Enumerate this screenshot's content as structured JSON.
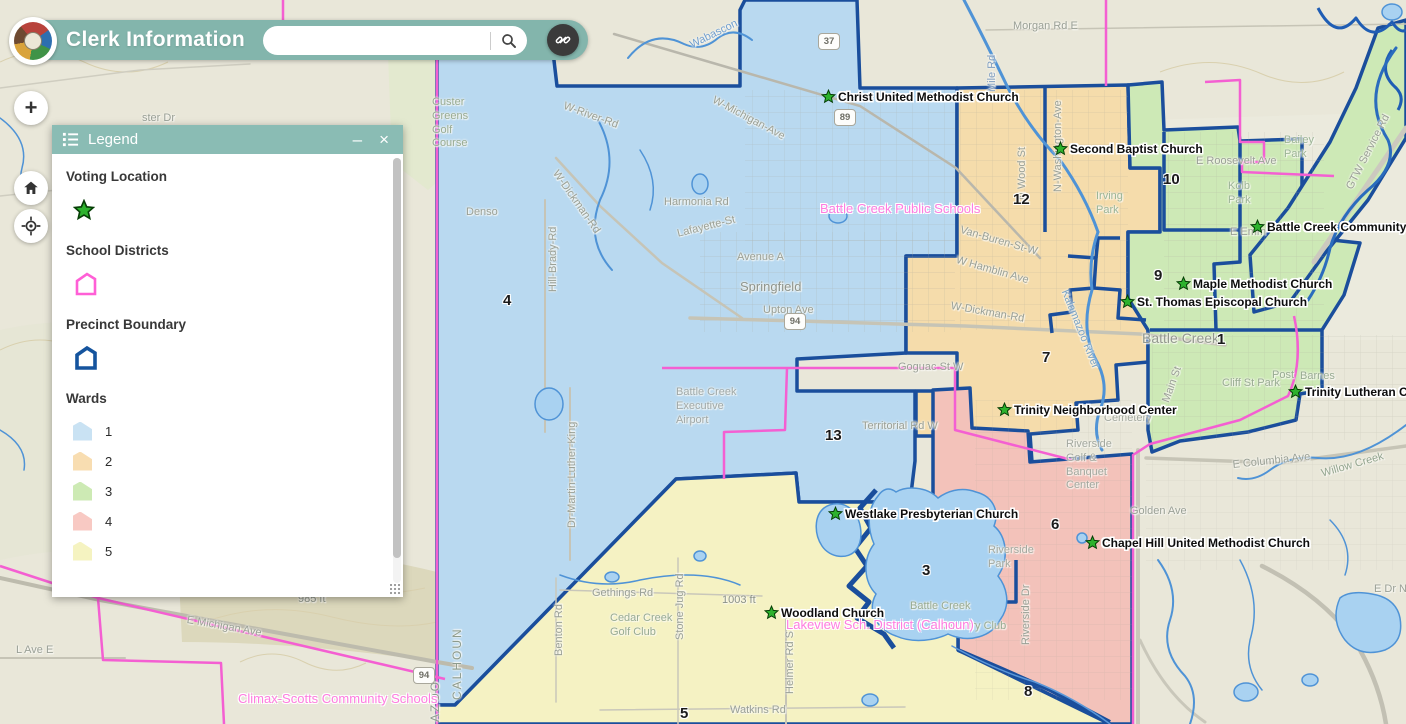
{
  "header": {
    "title": "Clerk Information",
    "search": {
      "value": "",
      "placeholder": ""
    }
  },
  "map_controls": {
    "zoom_in_label": "+"
  },
  "legend": {
    "title": "Legend",
    "minimize_label": "–",
    "close_label": "×",
    "sections": {
      "voting_location": {
        "heading": "Voting Location"
      },
      "school_districts": {
        "heading": "School Districts"
      },
      "precinct_boundary": {
        "heading": "Precinct Boundary"
      },
      "wards": {
        "heading": "Wards",
        "items": [
          {
            "label": "1",
            "fill": "#c9e2f3"
          },
          {
            "label": "2",
            "fill": "#f8ddb1"
          },
          {
            "label": "3",
            "fill": "#cdeab4"
          },
          {
            "label": "4",
            "fill": "#f8c9c3"
          },
          {
            "label": "5",
            "fill": "#f5f3c1"
          }
        ]
      }
    }
  },
  "map": {
    "colors": {
      "ward1_fill": "#b9d9f0",
      "ward2_fill": "#f5dcab",
      "ward3_fill": "#cde9b6",
      "ward4_fill": "#f3c2ba",
      "ward5_fill": "#f5f2c3",
      "precinct_line": "#1a4e9c",
      "school_district_line": "#f45fd2",
      "water_fill": "#a9d2f1",
      "voting_star": "#2db22d"
    },
    "voting_locations": [
      {
        "text": "Christ United Methodist Church",
        "x": 821,
        "y": 89
      },
      {
        "text": "Second Baptist Church",
        "x": 1053,
        "y": 141
      },
      {
        "text": "Battle Creek Community",
        "x": 1250,
        "y": 219
      },
      {
        "text": "Maple Methodist Church",
        "x": 1176,
        "y": 276
      },
      {
        "text": "St. Thomas Episcopal Church",
        "x": 1120,
        "y": 294
      },
      {
        "text": "Trinity Lutheran Ch",
        "x": 1288,
        "y": 384
      },
      {
        "text": "Trinity Neighborhood Center",
        "x": 997,
        "y": 402
      },
      {
        "text": "Westlake Presbyterian Church",
        "x": 828,
        "y": 506
      },
      {
        "text": "Chapel Hill United Methodist Church",
        "x": 1085,
        "y": 535
      },
      {
        "text": "Woodland Church",
        "x": 764,
        "y": 605
      }
    ],
    "ward_numbers": [
      {
        "text": "4",
        "x": 503,
        "y": 292
      },
      {
        "text": "12",
        "x": 1013,
        "y": 191
      },
      {
        "text": "10",
        "x": 1163,
        "y": 171
      },
      {
        "text": "9",
        "x": 1154,
        "y": 267
      },
      {
        "text": "1",
        "x": 1217,
        "y": 331
      },
      {
        "text": "7",
        "x": 1042,
        "y": 349
      },
      {
        "text": "13",
        "x": 825,
        "y": 427
      },
      {
        "text": "3",
        "x": 922,
        "y": 562
      },
      {
        "text": "6",
        "x": 1051,
        "y": 516
      },
      {
        "text": "8",
        "x": 1024,
        "y": 683
      },
      {
        "text": "5",
        "x": 680,
        "y": 705
      }
    ],
    "district_labels": [
      {
        "text": "Battle Creek Public Schools",
        "x": 820,
        "y": 201
      },
      {
        "text": "Lakeview Sch. District (Calhoun)",
        "x": 786,
        "y": 617
      },
      {
        "text": "Climax-Scotts Community Schools",
        "x": 238,
        "y": 691
      }
    ],
    "shields": [
      {
        "text": "37",
        "x": 818,
        "y": 33
      },
      {
        "text": "89",
        "x": 834,
        "y": 109
      },
      {
        "text": "94",
        "x": 784,
        "y": 313
      },
      {
        "text": "94",
        "x": 413,
        "y": 667
      }
    ],
    "base_labels": [
      {
        "text": "ster Dr",
        "x": 142,
        "y": 112
      },
      {
        "text": "Custer\nGreens\nGolf\nCourse",
        "x": 432,
        "y": 96,
        "color": "#98ab92"
      },
      {
        "text": "Denso",
        "x": 466,
        "y": 206
      },
      {
        "text": "W-Dickman-Rd",
        "x": 560,
        "y": 168,
        "rot": 55
      },
      {
        "text": "Harmonia Rd",
        "x": 664,
        "y": 196
      },
      {
        "text": "Lafayette-St",
        "x": 676,
        "y": 228,
        "rot": -14
      },
      {
        "text": "Avenue A",
        "x": 737,
        "y": 251
      },
      {
        "text": "Springfield",
        "x": 740,
        "y": 279,
        "size": 13,
        "color": "#8e948c"
      },
      {
        "text": "Upton Ave",
        "x": 763,
        "y": 304
      },
      {
        "text": "W-Michigan-Ave",
        "x": 716,
        "y": 94,
        "rot": 28
      },
      {
        "text": "W-Dickman-Rd",
        "x": 952,
        "y": 300,
        "rot": 10
      },
      {
        "text": "W Hamblin Ave",
        "x": 958,
        "y": 254,
        "rot": 16
      },
      {
        "text": "Van-Buren-St-W",
        "x": 962,
        "y": 224,
        "rot": 16
      },
      {
        "text": "N-Washington-Ave",
        "x": 1052,
        "y": 192,
        "rot": -90
      },
      {
        "text": "N Wood St",
        "x": 1016,
        "y": 200,
        "rot": -90
      },
      {
        "text": "Battle Creek",
        "x": 1142,
        "y": 330,
        "size": 14,
        "color": "#93998f"
      },
      {
        "text": "Battle Creek\nExecutive\nAirport",
        "x": 676,
        "y": 386,
        "color": "#9fa8a8"
      },
      {
        "text": "Territorial Rd W",
        "x": 862,
        "y": 420
      },
      {
        "text": "Goguac St W",
        "x": 898,
        "y": 361
      },
      {
        "text": "Riverside\nGolf &\nBanquet\nCenter",
        "x": 1066,
        "y": 438,
        "color": "#a3a89f"
      },
      {
        "text": "Riverside\nPark",
        "x": 988,
        "y": 544,
        "color": "#a3a89f"
      },
      {
        "text": "Riverside Dr",
        "x": 1020,
        "y": 645,
        "rot": -90
      },
      {
        "text": "Golden Ave",
        "x": 1130,
        "y": 505
      },
      {
        "text": "Cliff St Park",
        "x": 1222,
        "y": 377,
        "color": "#98ab92"
      },
      {
        "text": "Post",
        "x": 1272,
        "y": 369,
        "color": "#98ab92"
      },
      {
        "text": "Barnes",
        "x": 1300,
        "y": 370,
        "color": "#98ab92"
      },
      {
        "text": "Morgan Rd E",
        "x": 1013,
        "y": 20
      },
      {
        "text": "Mile Rd",
        "x": 986,
        "y": 92,
        "rot": -90,
        "color": "#7d9cc0"
      },
      {
        "text": "Bailey\nPark",
        "x": 1284,
        "y": 134,
        "color": "#9cb596"
      },
      {
        "text": "GTW Service Rd",
        "x": 1344,
        "y": 186,
        "rot": -63
      },
      {
        "text": "E Roosevelt Ave",
        "x": 1196,
        "y": 155
      },
      {
        "text": "E Emm",
        "x": 1230,
        "y": 226
      },
      {
        "text": "Kalamazoo River",
        "x": 1070,
        "y": 288,
        "rot": 68,
        "color": "#7aa3c4"
      },
      {
        "text": "Main St",
        "x": 1160,
        "y": 400,
        "rot": -70
      },
      {
        "text": "Wabascon",
        "x": 688,
        "y": 40,
        "rot": -26,
        "color": "#6f9ed0"
      },
      {
        "text": "W-River-Rd",
        "x": 566,
        "y": 100,
        "rot": 20
      },
      {
        "text": "Hill-Brady-Rd",
        "x": 547,
        "y": 292,
        "rot": -90
      },
      {
        "text": "Dr-Martin-Luther-King",
        "x": 566,
        "y": 528,
        "rot": -90
      },
      {
        "text": "Benton Rd",
        "x": 553,
        "y": 656,
        "rot": -90
      },
      {
        "text": "Stone Jug Rd",
        "x": 674,
        "y": 640,
        "rot": -90
      },
      {
        "text": "Helmer Rd S",
        "x": 784,
        "y": 694,
        "rot": -90
      },
      {
        "text": "Gethings Rd",
        "x": 592,
        "y": 587
      },
      {
        "text": "1003 ft",
        "x": 722,
        "y": 594,
        "color": "#8c9287"
      },
      {
        "text": "Cedar Creek\nGolf Club",
        "x": 610,
        "y": 612,
        "color": "#98ab92"
      },
      {
        "text": "Watkins Rd",
        "x": 730,
        "y": 704
      },
      {
        "text": "Battle Creek",
        "x": 910,
        "y": 600,
        "color": "#98ab92"
      },
      {
        "text": "Country Club",
        "x": 942,
        "y": 620,
        "color": "#98ab92"
      },
      {
        "text": "Irving\nPark",
        "x": 1096,
        "y": 190,
        "color": "#9cb596"
      },
      {
        "text": "Kolb\nPark",
        "x": 1228,
        "y": 180,
        "color": "#9cb596"
      },
      {
        "text": "Cemetery",
        "x": 1104,
        "y": 412,
        "color": "#a3a89f"
      },
      {
        "text": "E Michigan Ave",
        "x": 188,
        "y": 614,
        "rot": 10
      },
      {
        "text": "985 ft",
        "x": 298,
        "y": 593,
        "color": "#8c9287"
      },
      {
        "text": "L Ave E",
        "x": 16,
        "y": 644
      },
      {
        "text": "E Dr N",
        "x": 1374,
        "y": 583
      },
      {
        "text": "E Columbia Ave",
        "x": 1232,
        "y": 459,
        "rot": -6
      },
      {
        "text": "Willow Creek",
        "x": 1320,
        "y": 468,
        "rot": -16,
        "color": "#93a58f"
      },
      {
        "text": "AZOO",
        "x": 428,
        "y": 722,
        "rot": -90,
        "size": 12,
        "ls": 2,
        "color": "#8d9b8d"
      },
      {
        "text": "CALHOUN",
        "x": 450,
        "y": 700,
        "rot": -90,
        "size": 12,
        "ls": 2,
        "color": "#8d9b8d"
      }
    ]
  }
}
